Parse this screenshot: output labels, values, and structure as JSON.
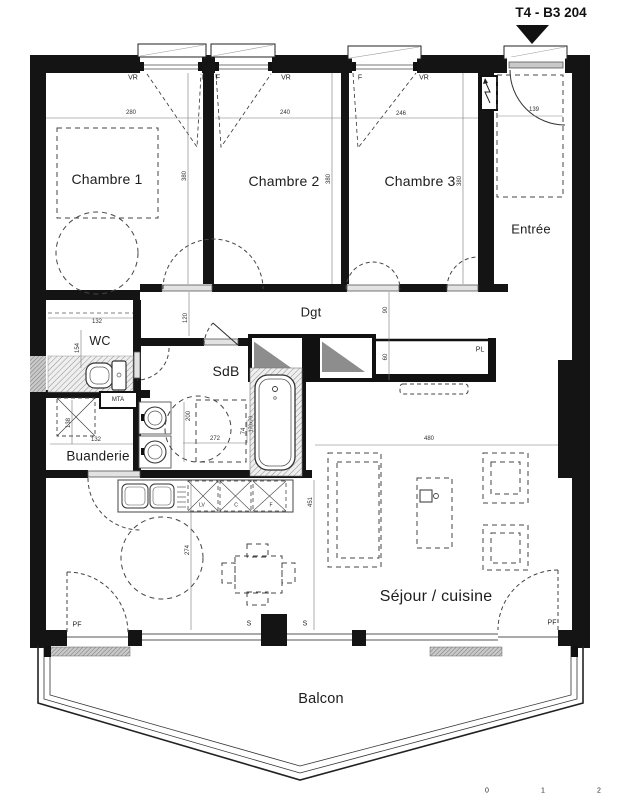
{
  "title": "T4 - B3 204",
  "rooms": {
    "chambre1": "Chambre 1",
    "chambre2": "Chambre 2",
    "chambre3": "Chambre 3",
    "entree": "Entrée",
    "dgt": "Dgt",
    "wc": "WC",
    "sdb": "SdB",
    "buanderie": "Buanderie",
    "sejour": "Séjour / cuisine",
    "balcon": "Balcon"
  },
  "closets": {
    "pl": "PL",
    "mta": "MTA"
  },
  "windows": {
    "w1_vr": "VR",
    "w1_f": "F",
    "w2_f": "F",
    "w2_vr": "VR",
    "w3_f": "F",
    "w3_vr": "VR"
  },
  "doors": {
    "pf_left": "PF",
    "pf_right": "PF",
    "s_left": "S",
    "s_right": "S"
  },
  "kitchen": {
    "lv": "LV",
    "c": "C",
    "f": "F"
  },
  "dimensions": {
    "chambre1_width": "280",
    "chambre2_width": "240",
    "chambre3_width": "246",
    "chambre1_depth": "380",
    "chambre2_depth": "380",
    "chambre3_depth": "380",
    "entry_door": "139",
    "dgt_left": "120",
    "dgt_right": "90",
    "pl_depth": "60",
    "wc_width": "132",
    "wc_depth": "154",
    "buanderie_depth": "138",
    "buanderie_width": "132",
    "sdb_depth": "200",
    "sdb_width": "272",
    "sdb_offset": "74",
    "bathtub": "170x70",
    "sejour_width": "480",
    "sejour_depth": "451",
    "cuisine_width": "274"
  },
  "scale_bar": {
    "t0": "0",
    "t1": "1",
    "t2": "2"
  }
}
